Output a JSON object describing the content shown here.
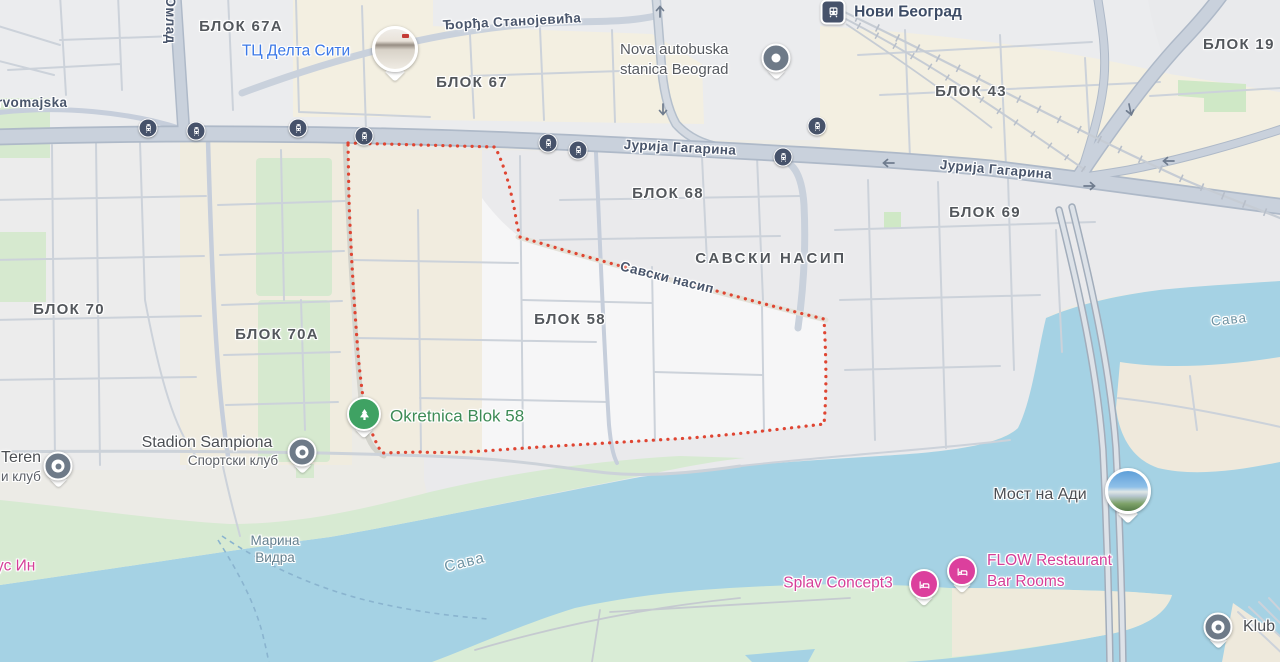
{
  "map": {
    "app": "map-view",
    "highlighted_region": "БЛОК 58",
    "colors": {
      "water": "#a5d2e4",
      "park": "#d6e9cf",
      "boundary_red": "#df4532",
      "road": "#c9d1dc",
      "poi_blue": "#3b78e7",
      "poi_green": "#3d8b56",
      "poi_pink": "#d53f98",
      "transit_dark": "#46526a",
      "label_gray": "#53575c",
      "water_label": "#6e93a3"
    },
    "labels": [
      {
        "name": "district-blok-67a",
        "text": "БЛОК 67А",
        "style": "district",
        "x": 241,
        "y": 27,
        "inter": false
      },
      {
        "name": "poi-delta-city",
        "text": "ТЦ Делта Сити",
        "style": "poi-blue",
        "x": 296,
        "y": 52,
        "inter": true
      },
      {
        "name": "district-blok-67",
        "text": "БЛОК 67",
        "style": "district",
        "x": 472,
        "y": 83,
        "inter": false
      },
      {
        "name": "street-djordja-stanojevica",
        "text": "Ђорђа Станојевића",
        "style": "street",
        "x": 512,
        "y": 22,
        "rot": -3,
        "inter": false
      },
      {
        "name": "transit-novi-beograd",
        "text": "Нови Београд",
        "style": "transit-name",
        "x": 908,
        "y": 13,
        "inter": true
      },
      {
        "name": "poi-nova-autobuska",
        "text": "Nova autobuska\nstanica Beograd",
        "style": "poi",
        "x": 620,
        "y": 60,
        "align": "left",
        "inter": true
      },
      {
        "name": "district-blok-19",
        "text": "БЛОК 19",
        "style": "district",
        "x": 1203,
        "y": 45,
        "align": "left",
        "inter": false
      },
      {
        "name": "district-blok-43",
        "text": "БЛОК 43",
        "style": "district",
        "x": 971,
        "y": 92,
        "inter": false
      },
      {
        "name": "street-jurija-gagarina-1",
        "text": "Јурија Гагарина",
        "style": "street",
        "x": 680,
        "y": 148,
        "rot": 3,
        "inter": false
      },
      {
        "name": "street-jurija-gagarina-2",
        "text": "Јурија Гагарина",
        "style": "street",
        "x": 996,
        "y": 170,
        "rot": 5,
        "inter": false
      },
      {
        "name": "district-blok-68",
        "text": "БЛОК 68",
        "style": "district",
        "x": 668,
        "y": 194,
        "inter": false
      },
      {
        "name": "district-blok-69",
        "text": "БЛОК 69",
        "style": "district",
        "x": 985,
        "y": 213,
        "inter": false
      },
      {
        "name": "district-savski-nasip",
        "text": "САВСКИ НАСИП",
        "style": "district-wide",
        "x": 771,
        "y": 259,
        "inter": false
      },
      {
        "name": "street-savski-nasip",
        "text": "Савски насип",
        "style": "street",
        "x": 667,
        "y": 278,
        "rot": 14,
        "inter": false
      },
      {
        "name": "district-blok-70",
        "text": "БЛОК 70",
        "style": "district",
        "x": 69,
        "y": 310,
        "inter": false
      },
      {
        "name": "district-blok-70a",
        "text": "БЛОК 70А",
        "style": "district",
        "x": 277,
        "y": 335,
        "inter": false
      },
      {
        "name": "district-blok-58",
        "text": "БЛОК 58",
        "style": "district",
        "x": 570,
        "y": 320,
        "inter": false
      },
      {
        "name": "poi-okretnica",
        "text": "Okretnica Blok 58",
        "style": "poi-green",
        "x": 390,
        "y": 417,
        "align": "left",
        "inter": true
      },
      {
        "name": "poi-stadion-sampiona",
        "text": "Stadion Sampiona",
        "style": "poi-lg",
        "x": 207,
        "y": 443,
        "inter": true
      },
      {
        "name": "poi-sportski-klub",
        "text": "Спортски клуб",
        "style": "poi-sub",
        "x": 233,
        "y": 461,
        "inter": true
      },
      {
        "name": "poi-teren",
        "text": "Teren",
        "style": "poi-lg",
        "x": 1,
        "y": 458,
        "align": "left",
        "inter": true
      },
      {
        "name": "poi-teren-sub",
        "text": "и клуб",
        "style": "poi-sub",
        "x": 1,
        "y": 477,
        "align": "left",
        "inter": true
      },
      {
        "name": "poi-marina-vidra-1",
        "text": "Марина",
        "style": "water-poi",
        "x": 275,
        "y": 541,
        "inter": true
      },
      {
        "name": "poi-marina-vidra-2",
        "text": "Видра",
        "style": "water-poi",
        "x": 275,
        "y": 558,
        "inter": true
      },
      {
        "name": "poi-us-in",
        "text": "ус Ин",
        "style": "poi-pink",
        "x": -4,
        "y": 567,
        "align": "left",
        "inter": true
      },
      {
        "name": "water-sava-main",
        "text": "Сава",
        "style": "water",
        "x": 465,
        "y": 563,
        "rot": -14,
        "inter": false
      },
      {
        "name": "poi-most-na-adi",
        "text": "Мост на Ади",
        "style": "poi-lg",
        "x": 1040,
        "y": 495,
        "inter": true
      },
      {
        "name": "poi-splav-concept3",
        "text": "Splav Concept3",
        "style": "poi-pink",
        "x": 838,
        "y": 584,
        "inter": true
      },
      {
        "name": "poi-flow-restaurant",
        "text": "FLOW Restaurant\nBar Rooms",
        "style": "poi-pink",
        "x": 987,
        "y": 572,
        "align": "left",
        "inter": true
      },
      {
        "name": "water-sava-ne",
        "text": "Сава",
        "style": "water-sm",
        "x": 1229,
        "y": 320,
        "rot": -6,
        "inter": false
      },
      {
        "name": "poi-klub",
        "text": "Klub",
        "style": "poi-lg",
        "x": 1259,
        "y": 627,
        "inter": true
      },
      {
        "name": "street-prvomajska",
        "text": "rvomajska",
        "style": "street",
        "x": -3,
        "y": 103,
        "align": "left",
        "inter": false
      },
      {
        "name": "street-omladinskih",
        "text": "Омлад",
        "style": "street",
        "x": 170,
        "y": 20,
        "rot": 90,
        "inter": false
      }
    ],
    "pins": [
      {
        "name": "delta-city-photo-pin",
        "type": "photo",
        "photo": "mall",
        "x": 395,
        "y": 49
      },
      {
        "name": "nova-autobuska-pin",
        "type": "dot",
        "x": 776,
        "y": 58
      },
      {
        "name": "novi-beograd-station-icon",
        "type": "station",
        "x": 833,
        "y": 12
      },
      {
        "name": "okretnica-tree-pin",
        "type": "tree",
        "x": 364,
        "y": 414
      },
      {
        "name": "stadion-sampiona-pin",
        "type": "donut",
        "x": 302,
        "y": 452
      },
      {
        "name": "teren-pin",
        "type": "donut",
        "x": 58,
        "y": 466
      },
      {
        "name": "most-na-adi-photo-pin",
        "type": "photo",
        "photo": "bridge",
        "x": 1128,
        "y": 491
      },
      {
        "name": "splav-concept3-pin",
        "type": "bed",
        "x": 924,
        "y": 584
      },
      {
        "name": "flow-pin",
        "type": "bed",
        "x": 962,
        "y": 571
      },
      {
        "name": "klub-pin",
        "type": "donut",
        "x": 1218,
        "y": 627
      }
    ],
    "bus_stops": [
      [
        148,
        128
      ],
      [
        196,
        131
      ],
      [
        298,
        128
      ],
      [
        364,
        136
      ],
      [
        548,
        143
      ],
      [
        578,
        150
      ],
      [
        783,
        157
      ],
      [
        817,
        126
      ]
    ]
  }
}
